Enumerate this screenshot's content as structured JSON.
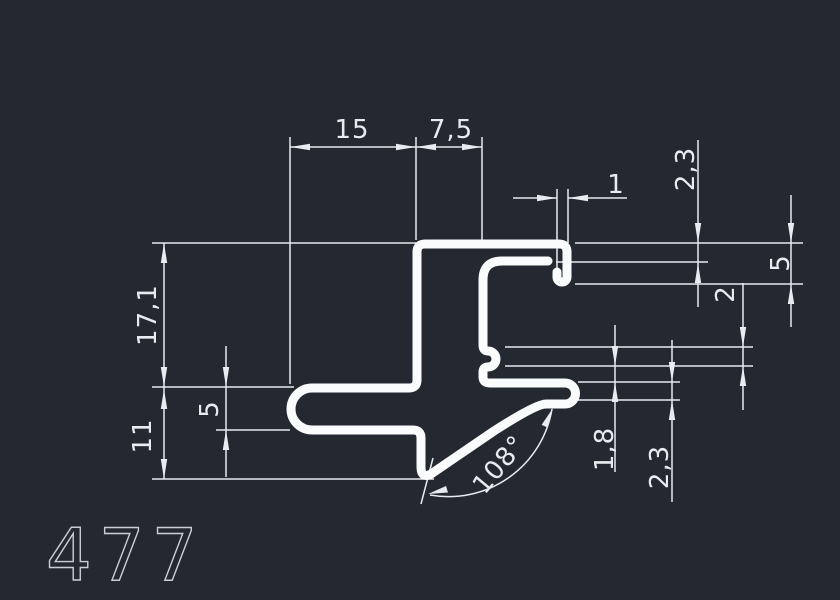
{
  "part_label": "477",
  "colors": {
    "background": "#232831",
    "profile": "#fafbfd",
    "dimension": "#e8ebef",
    "label": "#c9ced6"
  },
  "dimensions": {
    "top_width": "15",
    "top_inset": "7,5",
    "lip_thickness": "1",
    "top_wall": "2,3",
    "hook_depth": "5",
    "nub_height": "2",
    "overall_height": "17,1",
    "left_arm_thickness": "5",
    "lower_height": "11",
    "gap": "1,8",
    "right_arm_thickness": "2,3",
    "tail_angle": "108°"
  }
}
